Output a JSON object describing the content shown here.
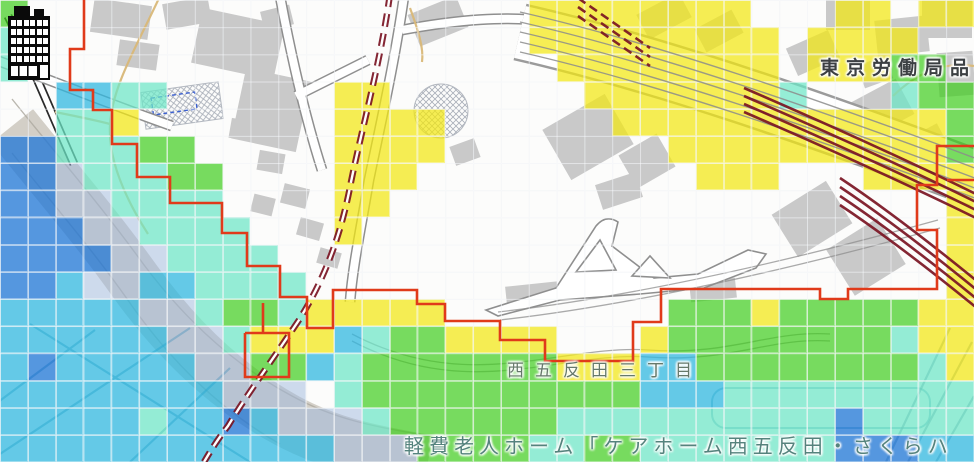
{
  "map": {
    "labels": {
      "bureau": "東京労働局品",
      "district": "西五反田三丁目",
      "facility": "軽費老人ホーム「ケアホーム西五反田・さくらハ"
    },
    "marker": {
      "type": "building-icon"
    },
    "colors": {
      "boundary_red": "#e03a1a",
      "railway_maroon": "#7a1423",
      "road_band": "#d3cfc7",
      "building_gray": "#c9c9c9",
      "tan_street": "#d9b878"
    },
    "flood_overlay": {
      "cell_w": 27.83,
      "cell_h": 27.18,
      "palette": {
        "y": "rgba(243,232,18,0.72)",
        "g": "rgba(62,205,28,0.70)",
        "a": "rgba(108,230,198,0.72)",
        "c": "rgba(47,183,224,0.74)",
        "b": "rgba(32,118,214,0.76)",
        "l": "rgba(158,184,222,0.50)"
      },
      "rows": [
        "g..................yyyyyyyy...yy.yy",
        "a..................yyyyyyyyy.yyyy..",
        "a...................yyyyyyyy.yyygg.",
        "..ccaa......yy.......yyyyyyya...agg",
        "..aay.......yyyy......yyyyyyyyyyyyg",
        "bbaaagg.....yyyy........yyyyyyyyyyg",
        "bblaaagg....yyy..........yyy...yyyy",
        "bbllaaaa....yy....................y",
        "bbbllaaaa...y.....................y",
        "bbbbllaaaa........................y",
        "bbcllccaaaa.......................y",
        "cccccllaggayyyyy........gggygggggyy",
        "ccccccllayyycaggyyyy...yggggggggayy",
        "cbcccccllggcagggggggyyyccggggggggay",
        "cccccccclll.aggggggggggcccaaaaaaaaa",
        "cccccaccbclllaggggggaaaaaaaaaabaaaa",
        "cccccccccccclllggggaaggaaaaaaabbbcc"
      ]
    }
  }
}
